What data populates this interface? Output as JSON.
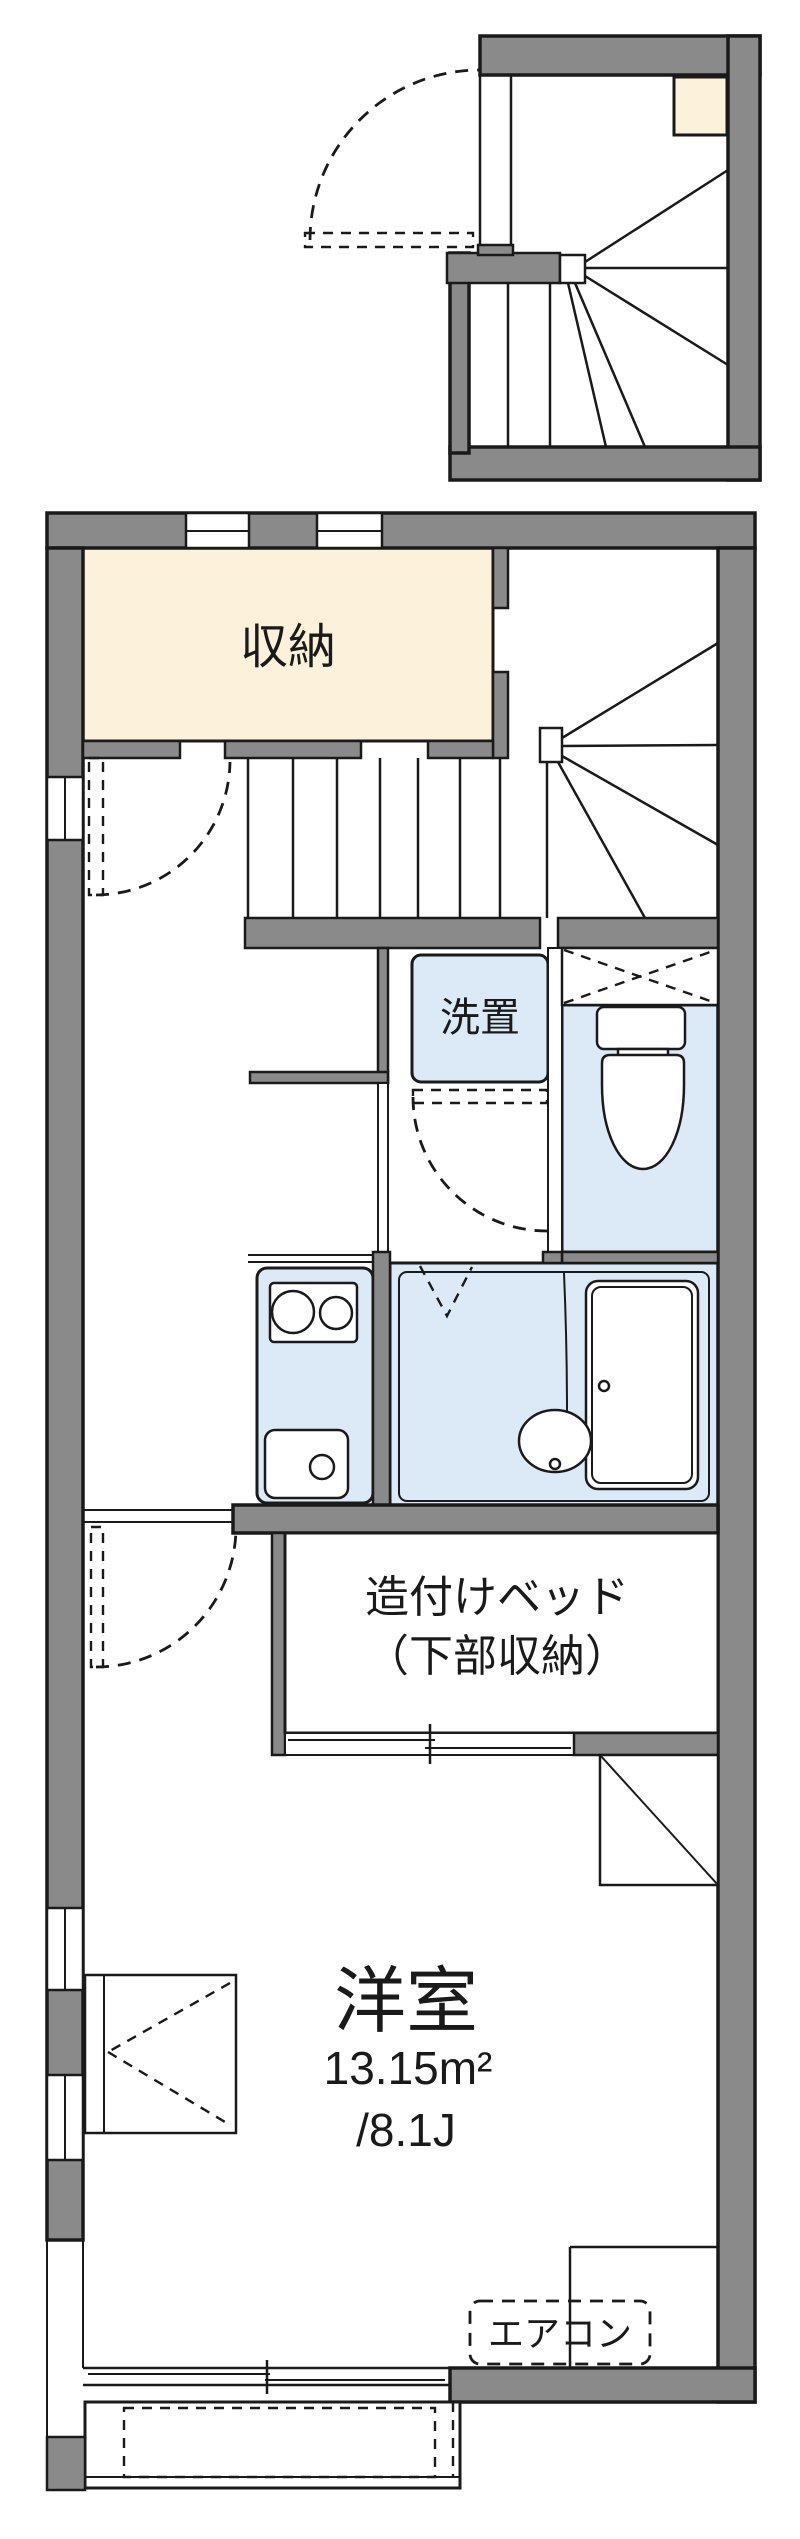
{
  "floorplan": {
    "labels": {
      "storage": "収納",
      "washer": "洗置",
      "bed_line1": "造付けベッド",
      "bed_line2": "（下部収納）",
      "room_name": "洋室",
      "room_area": "13.15m²",
      "room_tatami": "/8.1J",
      "aircon": "エアコン"
    },
    "colors": {
      "wall": "#8a8a8a",
      "line": "#1a1a1a",
      "storage-fill": "#fcf2dc",
      "fixture-fill": "#dce9f6",
      "bg": "#ffffff"
    }
  }
}
